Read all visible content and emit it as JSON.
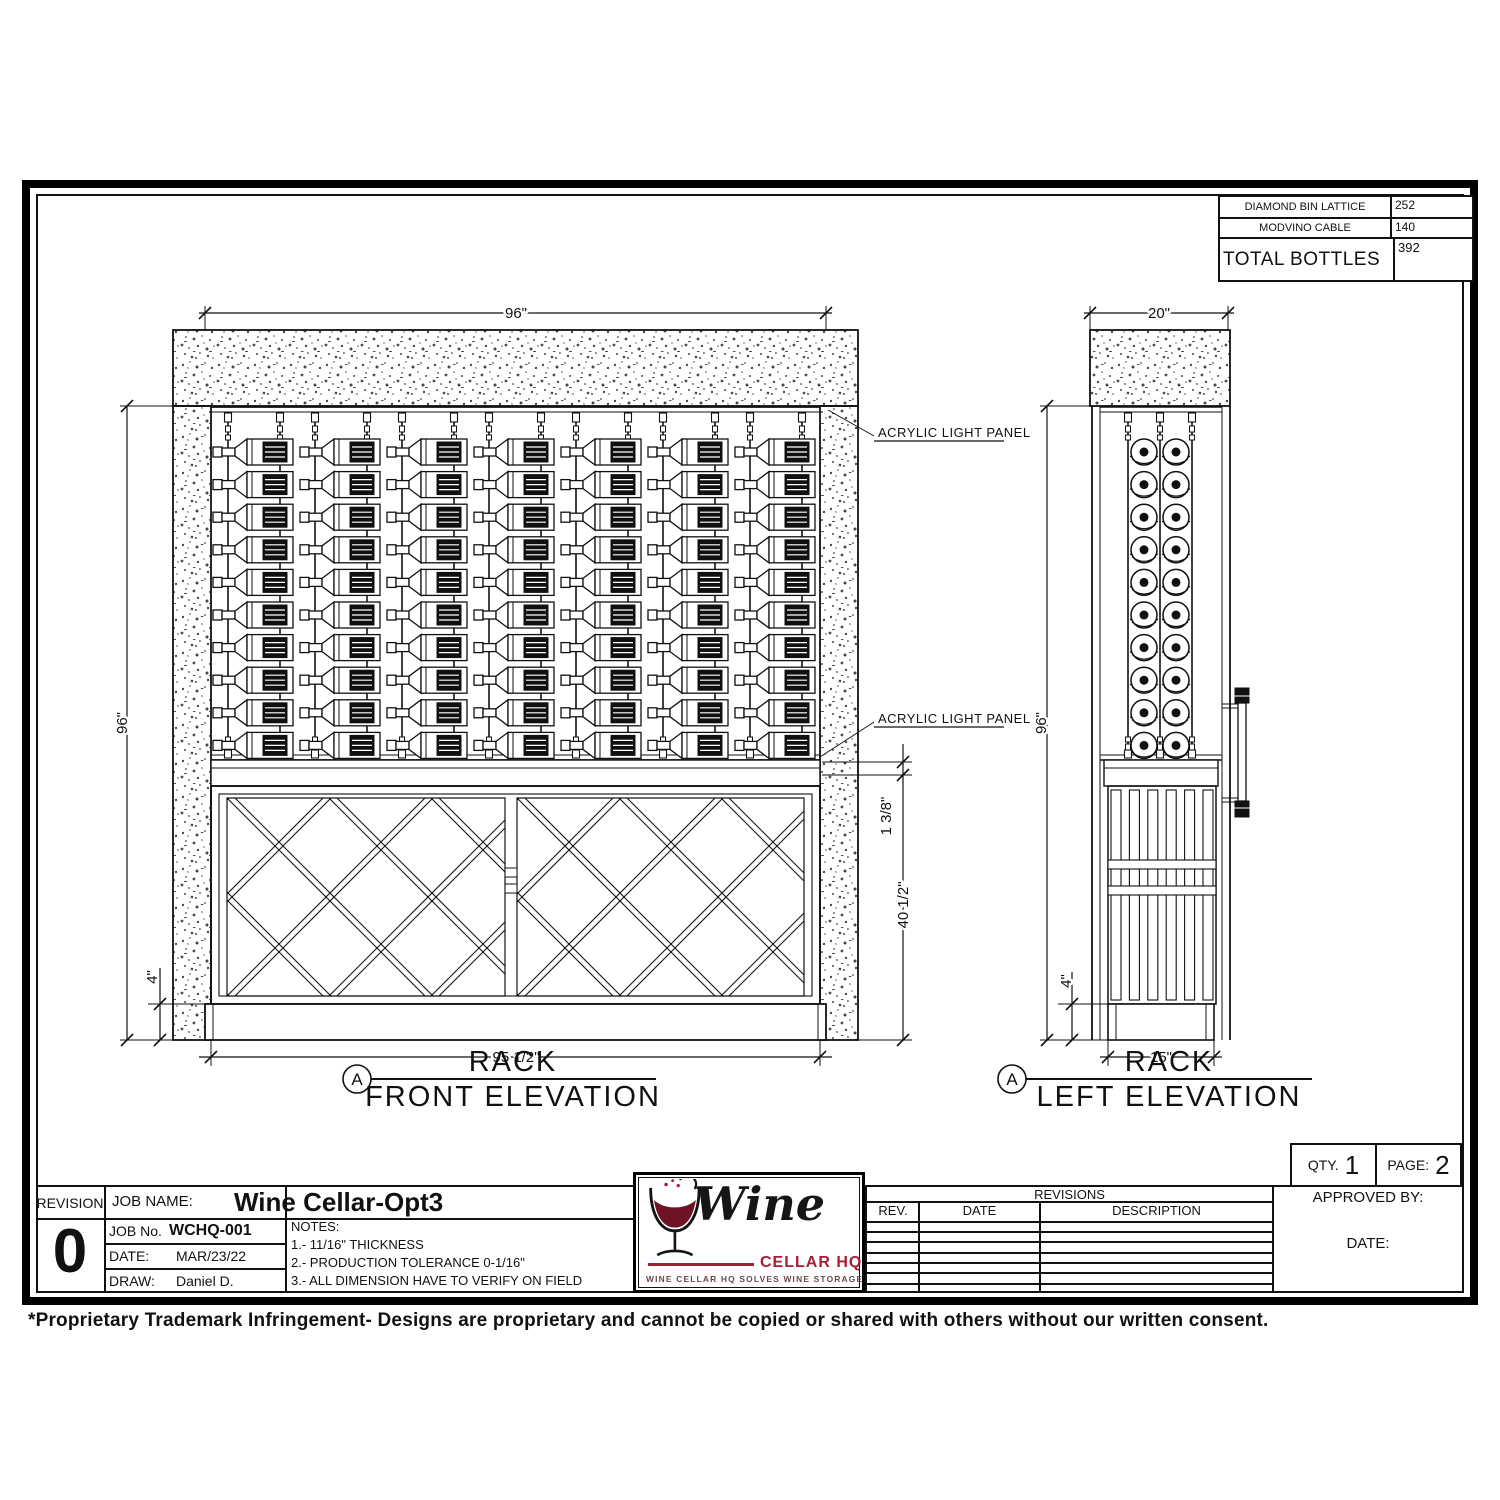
{
  "sheet": {
    "footer_note": "*Proprietary Trademark Infringement- Designs are proprietary and cannot be copied or shared with others without our written consent."
  },
  "summary_table": {
    "row1_label": "DIAMOND BIN LATTICE",
    "row1_value": "252",
    "row2_label": "MODVINO CABLE",
    "row2_value": "140",
    "row3_label": "TOTAL BOTTLES",
    "row3_value": "392"
  },
  "front_elevation": {
    "marker": "A",
    "title": "RACK",
    "subtitle": "FRONT ELEVATION",
    "dim_width_top": "96\"",
    "dim_height_left": "96\"",
    "dim_base_height": "4\"",
    "dim_width_bottom": "95 1/2\"",
    "dim_gap": "1 3/8\"",
    "dim_cabinet_height": "40 1/2\"",
    "annotation_top": "ACRYLIC LIGHT PANEL",
    "annotation_bottom": "ACRYLIC LIGHT PANEL",
    "rack": {
      "bottle_rows": 10,
      "bottle_columns": 7,
      "cables": 14
    }
  },
  "left_elevation": {
    "marker": "A",
    "title": "RACK",
    "subtitle": "LEFT ELEVATION",
    "dim_width_top": "20\"",
    "dim_height_left": "96\"",
    "dim_base_height": "4\"",
    "dim_width_bottom": "15\"",
    "rack": {
      "bottle_rows": 10,
      "bottle_columns": 2,
      "cables": 3
    }
  },
  "title_block": {
    "revision_label": "REVISION",
    "revision_value": "0",
    "job_name_label": "JOB  NAME:",
    "job_name_value": "Wine Cellar-Opt3",
    "job_no_label": "JOB  No.",
    "job_no_value": "WCHQ-001",
    "date_label": "DATE:",
    "date_value": "MAR/23/22",
    "draw_label": "DRAW:",
    "draw_value": "Daniel D.",
    "notes_label": "NOTES:",
    "note1": "1.-  11/16\" THICKNESS",
    "note2": "2.-  PRODUCTION  TOLERANCE  0-1/16\"",
    "note3": "3.-  ALL  DIMENSION  HAVE  TO  VERIFY  ON  FIELD",
    "qty_label": "QTY.",
    "qty_value": "1",
    "page_label": "PAGE:",
    "page_value": "2",
    "approved_label": "APPROVED  BY:",
    "approved_date_label": "DATE:",
    "revisions": {
      "header": "REVISIONS",
      "col_rev": "REV.",
      "col_date": "DATE",
      "col_description": "DESCRIPTION",
      "empty_rows": 7
    }
  },
  "logo": {
    "name": "Wine",
    "sub": "CELLAR HQ",
    "tagline": "Wine Cellar HQ Solves Wine Storage",
    "accent_color": "#a32035",
    "wine_color": "#6e1226"
  }
}
